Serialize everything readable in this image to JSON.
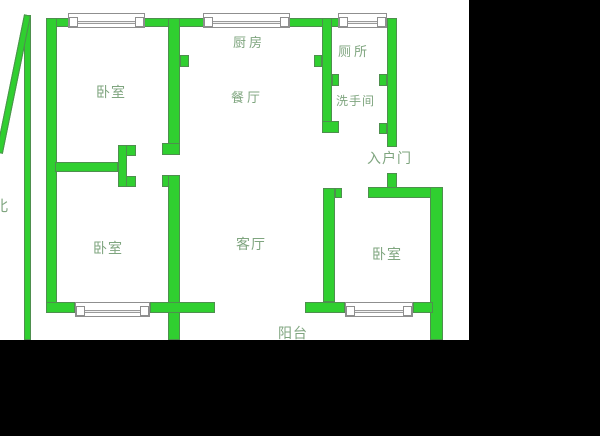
{
  "plan": {
    "type": "apartment-floor-plan",
    "compass": {
      "label": "北"
    },
    "rooms": {
      "bedroom_top_left": "卧室",
      "kitchen": "厨房",
      "dining": "餐厅",
      "toilet": "厕所",
      "washroom": "洗手间",
      "entry_door": "入户门",
      "bedroom_bottom_left": "卧室",
      "living": "客厅",
      "bedroom_right": "卧室",
      "balcony": "阳台"
    },
    "colors": {
      "wall_fill": "#30cf30",
      "wall_outline": "#4e8f4e",
      "window_line": "#9a9a9a",
      "label_text": "#7fa57f",
      "plan_background": "#ffffff",
      "letterbox": "#000000"
    }
  }
}
